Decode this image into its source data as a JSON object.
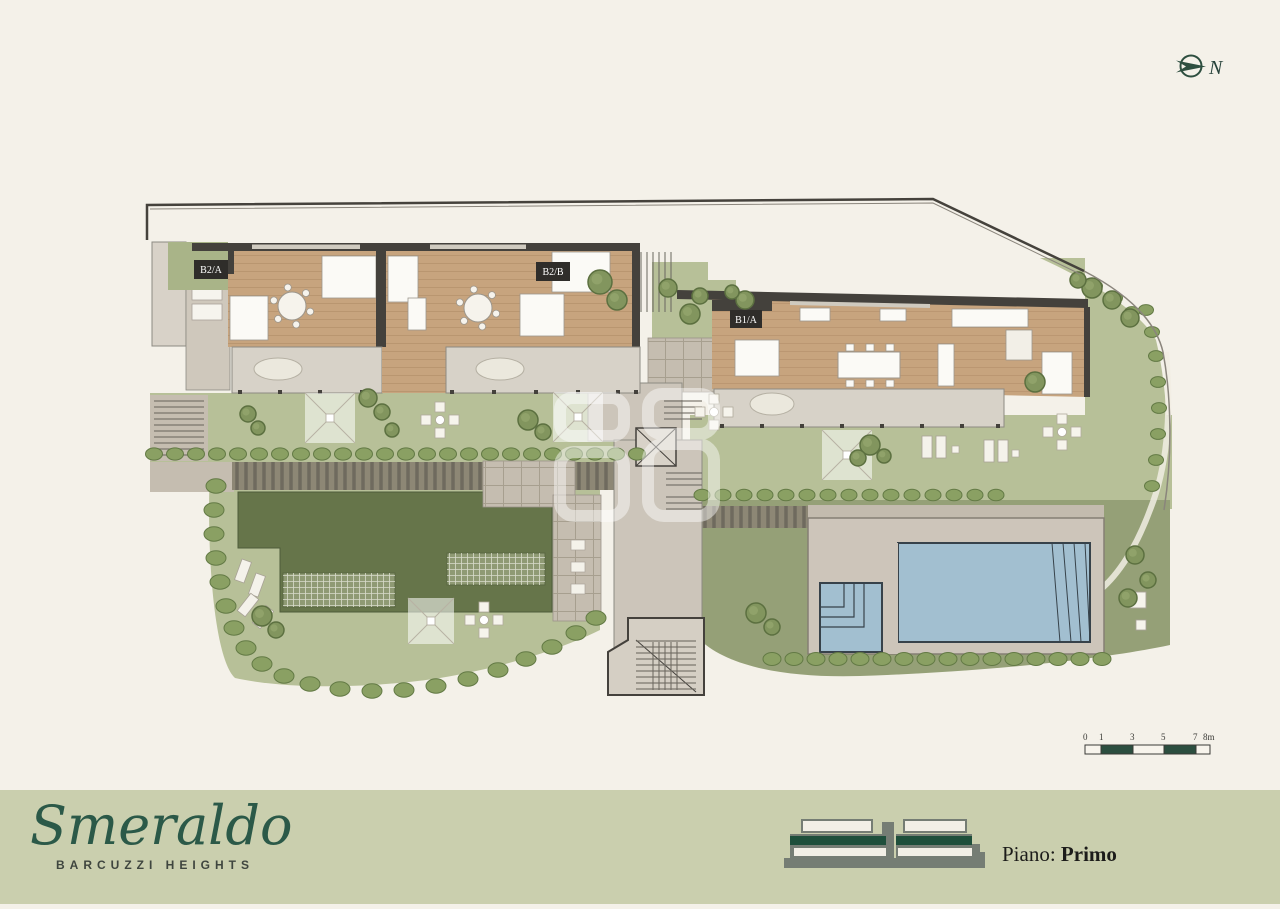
{
  "north": {
    "label": "N"
  },
  "plan": {
    "units": [
      {
        "id": "B2/A"
      },
      {
        "id": "B2/B"
      },
      {
        "id": "B1/A"
      }
    ]
  },
  "scale_bar": {
    "ticks": [
      "0",
      "1",
      "3",
      "5",
      "7",
      "8m"
    ]
  },
  "footer": {
    "brand": "Smeraldo",
    "brand_subtitle": "BARCUZZI HEIGHTS",
    "floor_label": "Piano:",
    "floor_value": "Primo"
  },
  "colors": {
    "background": "#f4f1e9",
    "band": "#cacfae",
    "accent_green": "#2b5948",
    "wall_dark": "#44413c",
    "wood": "#c7a47e",
    "lawn_light": "#b7c098",
    "lawn_dark": "#66754a",
    "lawn_olive": "#95a077",
    "pool_blue": "#a2bfd0",
    "paving": "#cdc5ba"
  }
}
